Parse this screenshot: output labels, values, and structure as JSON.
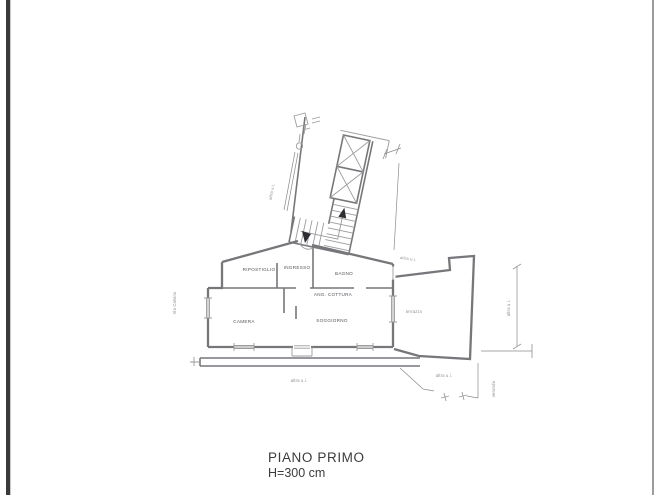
{
  "drawing": {
    "colors": {
      "paper": "#ffffff",
      "wall": "#77777b",
      "thin": "#9b9b9d",
      "faint": "#8a8a8c",
      "label": "#55555a",
      "title": "#3c3c3e",
      "border_left": "#3a3a3c",
      "border_right": "#9c9c9c",
      "arrow": "#2e2e32"
    },
    "icons": {
      "elevator": "elevator-shaft-x-icon",
      "entrance": "entrance-arrow-icon",
      "stairs": "staircase-treads"
    }
  },
  "plan": {
    "rooms": {
      "ripostiglio": "RIPOSTIGLIO",
      "ingresso": "INGRESSO",
      "bagno": "BAGNO",
      "ang_cottura": "ANG. COTTURA",
      "camera": "CAMERA",
      "soggiorno": "SOGGIORNO",
      "terrazzo": "terrazzo"
    },
    "annotations": {
      "upper_left": "altra u.i.",
      "near_stairs": "altra u.i.",
      "right_side": "altra u.i.",
      "below_balcony": "altra u.i.",
      "bottom_right": "altra u.i.",
      "veranda_vertical": "veranda",
      "street": "Via Calvino"
    },
    "title_block": {
      "floor": "PIANO PRIMO",
      "height": "H=300 cm"
    }
  }
}
